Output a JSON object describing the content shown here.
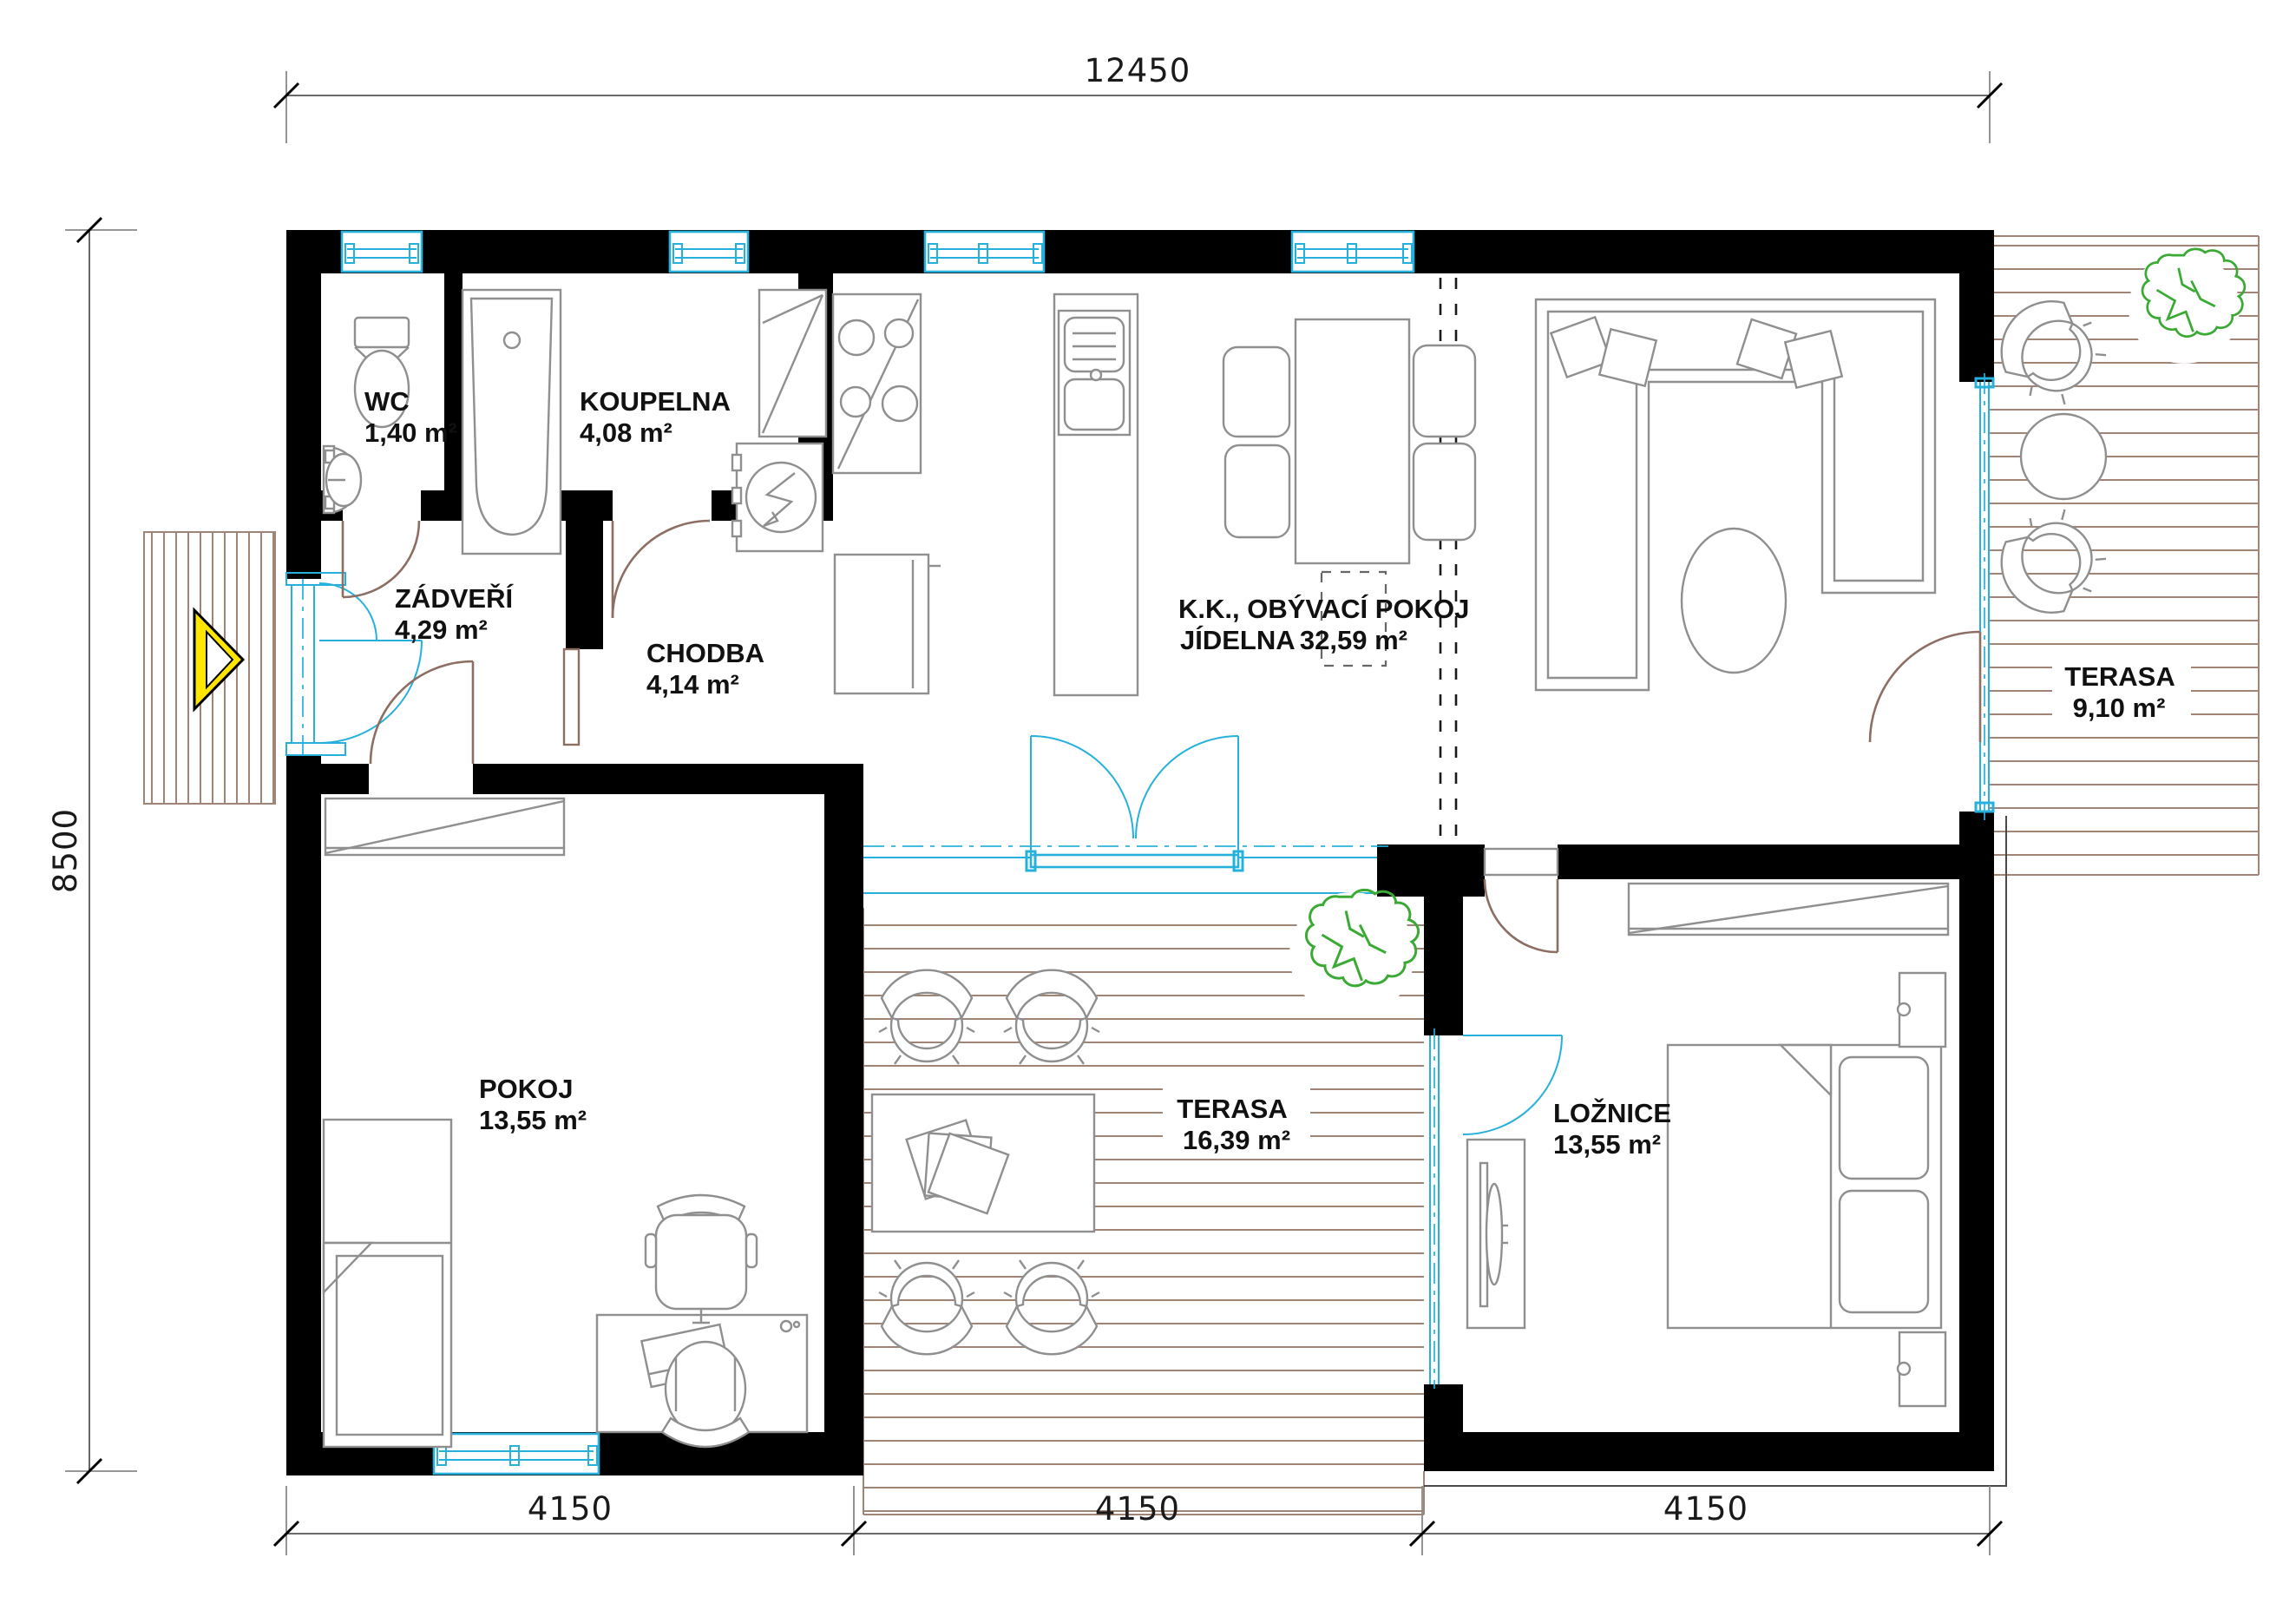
{
  "plan": {
    "title": "floor-plan",
    "dim_top": "12450",
    "dim_left": "8500",
    "dim_bottom": [
      "4150",
      "4150",
      "4150"
    ],
    "rooms": [
      {
        "name": "WC",
        "area": "1,40 m²"
      },
      {
        "name": "KOUPELNA",
        "area": "4,08 m²"
      },
      {
        "name": "ZÁDVEŘÍ",
        "area": "4,29 m²"
      },
      {
        "name": "CHODBA",
        "area": "4,14 m²"
      },
      {
        "name": "K.K., OBÝVACÍ POKOJ",
        "name2": "JÍDELNA",
        "area": "32,59 m²"
      },
      {
        "name": "TERASA",
        "area": "9,10 m²"
      },
      {
        "name": "POKOJ",
        "area": "13,55 m²"
      },
      {
        "name": "TERASA",
        "area": "16,39 m²"
      },
      {
        "name": "LOŽNICE",
        "area": "13,55 m²"
      }
    ],
    "colors": {
      "wall": "#000000",
      "window": "#26b0dc",
      "door_arc": "#8d6e63",
      "furniture": "#8f8f8f",
      "deck_hatch": "#a08576",
      "plant": "#3aaa35",
      "entrance_marker": "#ffe600"
    }
  }
}
